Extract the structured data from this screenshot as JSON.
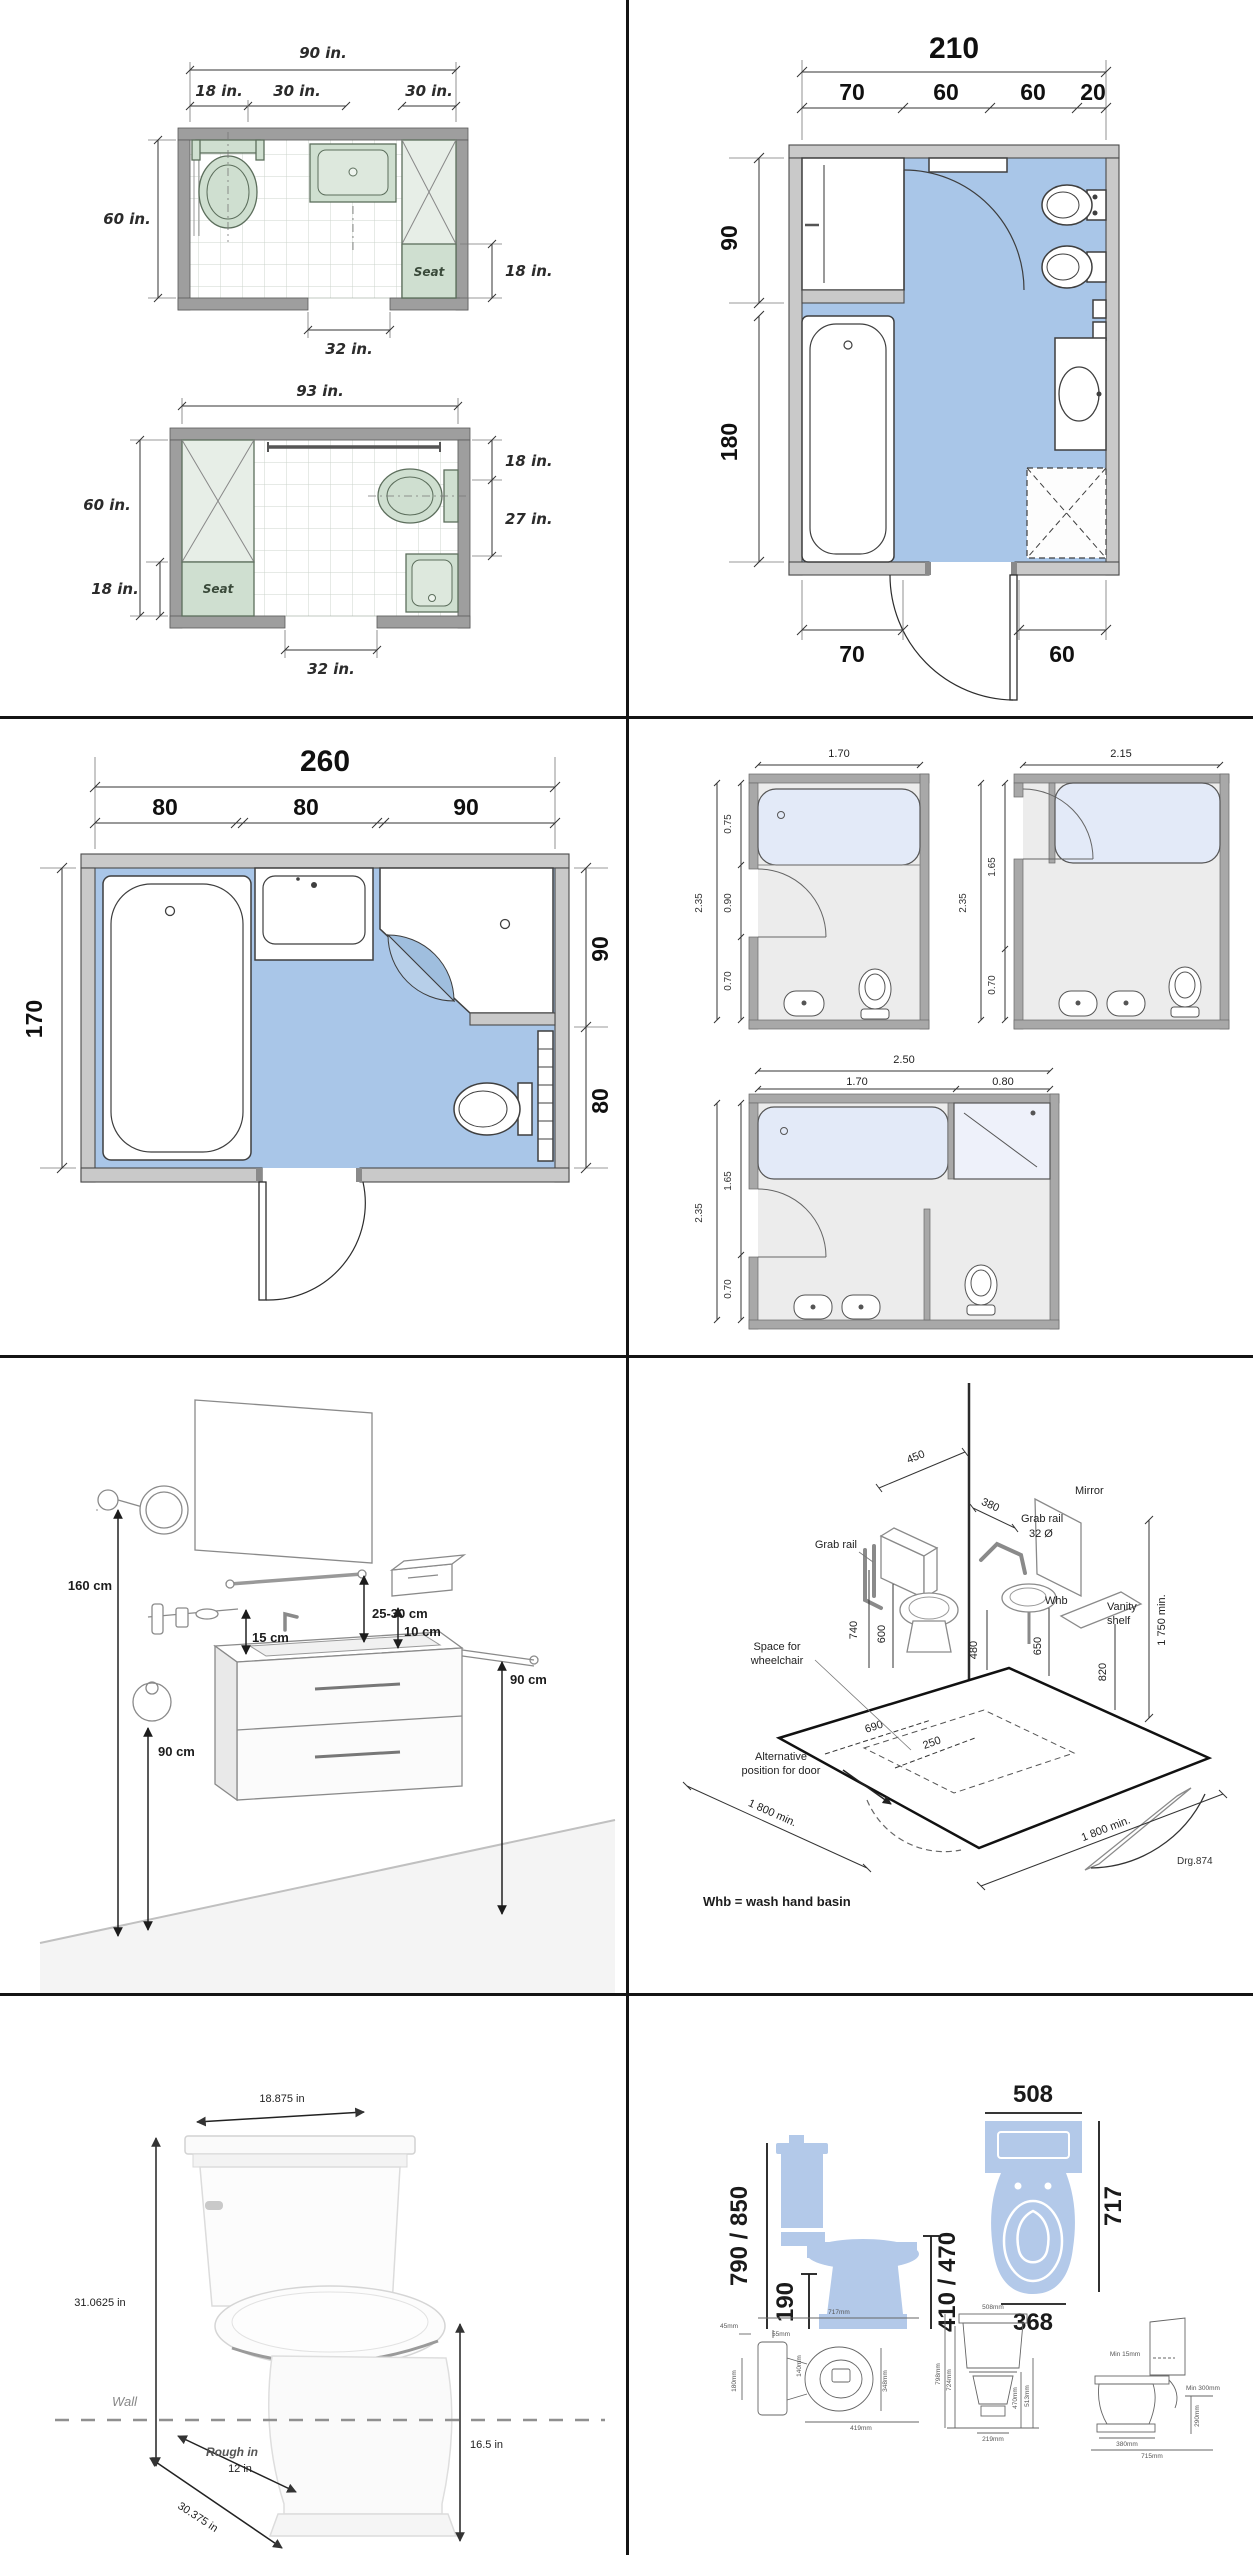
{
  "palette": {
    "floor_blue": "#a9c6e8",
    "fixture_green": "#cfdfd0",
    "wall_gray": "#9e9e9e",
    "silhouette_blue": "#b3c9e9"
  },
  "plan_a": {
    "overall": "90 in.",
    "d18": "18 in.",
    "d30a": "30 in.",
    "d30b": "30 in.",
    "height": "60 in.",
    "seat_depth": "18 in.",
    "door": "32 in.",
    "seat": "Seat"
  },
  "plan_b": {
    "overall": "93 in.",
    "height": "60 in.",
    "left18": "18 in.",
    "right18": "18 in.",
    "right27": "27 in.",
    "door": "32 in.",
    "seat": "Seat"
  },
  "plan210": {
    "overall": "210",
    "s1": "70",
    "s2": "60",
    "s3": "60",
    "s4": "20",
    "left_top": "90",
    "left_bottom": "180",
    "bottom_left": "70",
    "bottom_right": "60"
  },
  "plan260": {
    "overall": "260",
    "s1": "80",
    "s2": "80",
    "s3": "90",
    "left": "170",
    "right_top": "90",
    "right_bottom": "80"
  },
  "small1": {
    "w": "1.70",
    "h": "2.35",
    "a": "0.75",
    "b": "0.90",
    "c": "0.70"
  },
  "small2": {
    "w": "2.15",
    "h": "2.35",
    "a": "1.65",
    "b": "0.70"
  },
  "small3": {
    "w": "2.50",
    "wa": "1.70",
    "wb": "0.80",
    "h": "2.35",
    "a": "1.65",
    "b": "0.70"
  },
  "vanity": {
    "mirror_h": "160 cm",
    "shelf": "25-30 cm",
    "acc": "15 cm",
    "gap": "10 cm",
    "rail": "90 cm",
    "ring": "90 cm"
  },
  "wc": {
    "d450": "450",
    "d380": "380",
    "grab_top": "Grab rail",
    "dia": "32 Ø",
    "mirror": "Mirror",
    "grab_left": "Grab rail",
    "whb": "Whb",
    "shelf": [
      "Vanity",
      "shelf"
    ],
    "d1750": "1 750 min.",
    "d740": "740",
    "d600": "600",
    "d480": "480",
    "d650": "650",
    "d820": "820",
    "d690": "690",
    "d250": "250",
    "space": [
      "Space for",
      "wheelchair"
    ],
    "alt": [
      "Alternative",
      "position for door"
    ],
    "left1800": "1 800 min.",
    "right1800": "1 800 min.",
    "ref": "Drg.874",
    "note": "Whb = wash hand basin"
  },
  "toilet": {
    "w": "18.875 in",
    "h": "31.0625 in",
    "wall": "Wall",
    "rough": "Rough in",
    "rough_v": "12 in",
    "depth": "30.375 in",
    "seat": "16.5 in"
  },
  "tdims": {
    "d508": "508",
    "d790": "790 / 850",
    "d190": "190",
    "d410": "410 / 470",
    "d368": "368",
    "d717": "717",
    "t1": [
      "717mm",
      "45mm",
      "55mm",
      "140mm",
      "180mm",
      "348mm",
      "419mm"
    ],
    "t2": [
      "508mm",
      "798mm",
      "724mm",
      "470mm",
      "513mm",
      "219mm"
    ],
    "t3": [
      "Min 15mm",
      "Min 300mm",
      "290mm",
      "380mm",
      "715mm"
    ]
  }
}
